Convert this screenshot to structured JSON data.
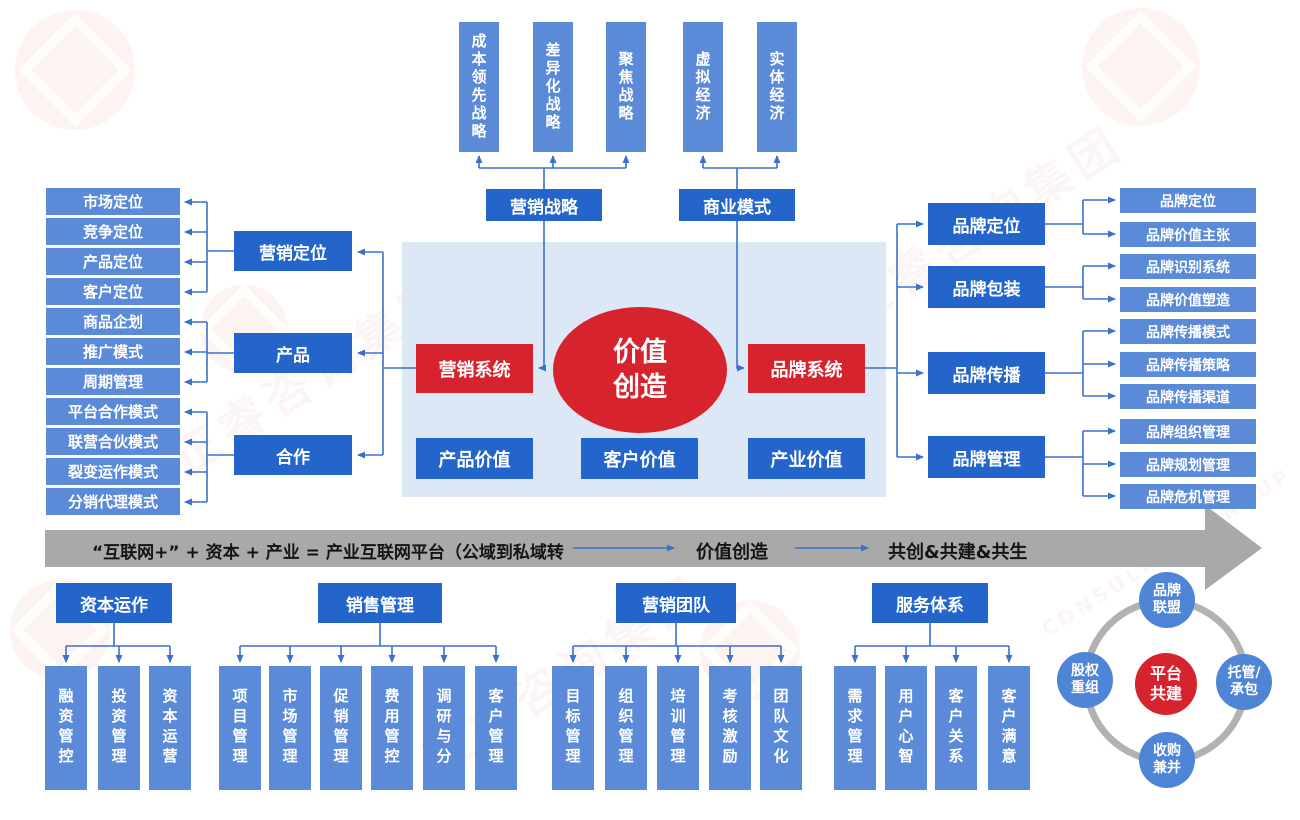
{
  "watermark": {
    "text": "正睿咨询集团",
    "subtext": "CONSULTING GROUP"
  },
  "colors": {
    "light_blue": "#5b8bd8",
    "dark_blue": "#2365ca",
    "red": "#d6232e",
    "panel_blue": "#dce8f5",
    "band_gray": "#a9a9a9",
    "connector_blue": "#3c70cf",
    "ring_gray": "#b2b2b2",
    "satellite_blue": "#4e85d6"
  },
  "top": {
    "marketing_strategy": {
      "label": "营销战略",
      "children": [
        "成本领先战略",
        "差异化战略",
        "聚焦战略"
      ]
    },
    "business_model": {
      "label": "商业模式",
      "children": [
        "虚拟经济",
        "实体经济"
      ]
    }
  },
  "left_groups": [
    {
      "parent": "营销定位",
      "children": [
        "市场定位",
        "竞争定位",
        "产品定位",
        "客户定位"
      ]
    },
    {
      "parent": "产品",
      "children": [
        "商品企划",
        "推广模式",
        "周期管理"
      ]
    },
    {
      "parent": "合作",
      "children": [
        "平台合作模式",
        "联营合伙模式",
        "裂变运作模式",
        "分销代理模式"
      ]
    }
  ],
  "center": {
    "marketing_system": "营销系统",
    "value_creation": "价值\n创造",
    "brand_system": "品牌系统",
    "values": [
      "产品价值",
      "客户价值",
      "产业价值"
    ]
  },
  "right_groups": [
    {
      "parent": "品牌定位",
      "children": [
        "品牌定位",
        "品牌价值主张"
      ]
    },
    {
      "parent": "品牌包装",
      "children": [
        "品牌识别系统",
        "品牌价值塑造"
      ]
    },
    {
      "parent": "品牌传播",
      "children": [
        "品牌传播模式",
        "品牌传播策略",
        "品牌传播渠道"
      ]
    },
    {
      "parent": "品牌管理",
      "children": [
        "品牌组织管理",
        "品牌规划管理",
        "品牌危机管理"
      ]
    }
  ],
  "band": {
    "formula": "“互联网+”  + 资本 + 产业 = 产业互联网平台（公域到私域转",
    "step2": "价值创造",
    "step3": "共创&共建&共生"
  },
  "bottom_sections": [
    {
      "title": "资本运作",
      "children": [
        "融资管控",
        "投资管理",
        "资本运营"
      ]
    },
    {
      "title": "销售管理",
      "children": [
        "项目管理",
        "市场管理",
        "促销管理",
        "费用管控",
        "调研与分",
        "客户管理"
      ]
    },
    {
      "title": "营销团队",
      "children": [
        "目标管理",
        "组织管理",
        "培训管理",
        "考核激励",
        "团队文化"
      ]
    },
    {
      "title": "服务体系",
      "children": [
        "需求管理",
        "用户心智",
        "客户关系",
        "客户满意"
      ]
    }
  ],
  "platform": {
    "center": "平台\n共建",
    "satellites": [
      "品牌\n联盟",
      "托管/\n承包",
      "收购\n兼并",
      "股权\n重组"
    ]
  }
}
